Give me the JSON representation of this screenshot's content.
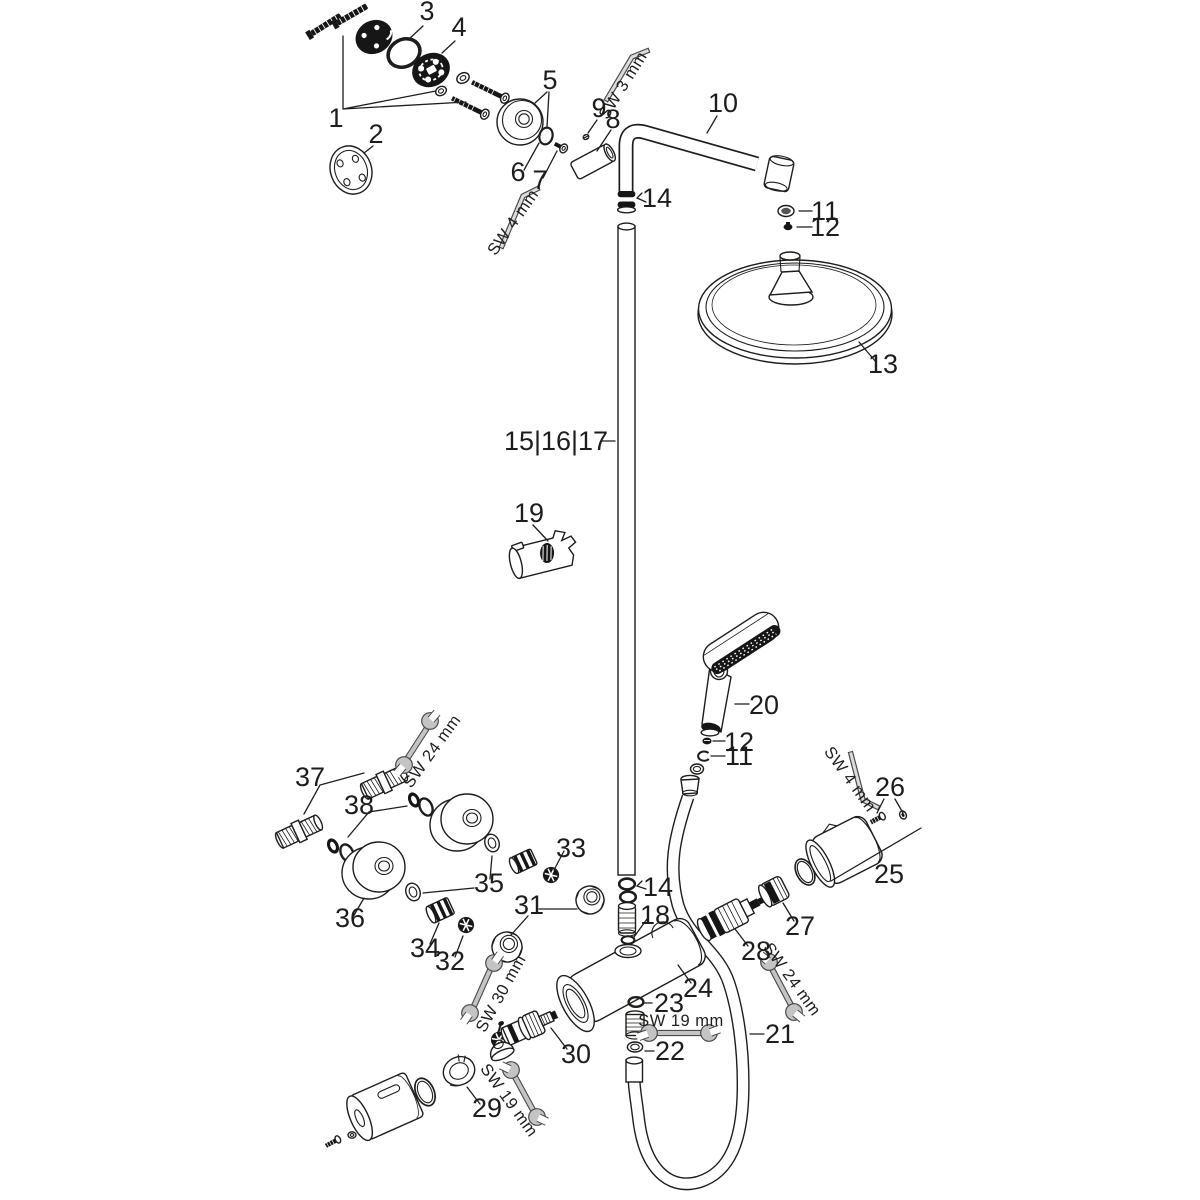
{
  "diagram": {
    "background_color": "#ffffff",
    "line_color": "#1d1d1b",
    "dark_part_color": "#161616",
    "tool_fill_color": "#c4c4c4",
    "tool_stroke_color": "#4a4a4a"
  },
  "labels": {
    "p1": "1",
    "p2": "2",
    "p3": "3",
    "p4": "4",
    "p5": "5",
    "p6": "6",
    "p7": "7",
    "p8": "8",
    "p9": "9",
    "p10": "10",
    "p11a": "11",
    "p11b": "11",
    "p12a": "12",
    "p12b": "12",
    "p13": "13",
    "p14a": "14",
    "p14b": "14",
    "p151617": "15|16|17",
    "p18": "18",
    "p19": "19",
    "p20": "20",
    "p21": "21",
    "p22": "22",
    "p23": "23",
    "p24": "24",
    "p25": "25",
    "p26": "26",
    "p27": "27",
    "p28": "28",
    "p29": "29",
    "p30": "30",
    "p31": "31",
    "p32": "32",
    "p33": "33",
    "p34": "34",
    "p35": "35",
    "p36": "36",
    "p37": "37",
    "p38": "38",
    "sw3": "SW 3 mm",
    "sw4a": "SW 4 mm",
    "sw4b": "SW 4 mm",
    "sw19a": "SW 19 mm",
    "sw19b": "SW 19 mm",
    "sw24a": "SW 24 mm",
    "sw24b": "SW 24 mm",
    "sw30": "SW 30 mm"
  }
}
